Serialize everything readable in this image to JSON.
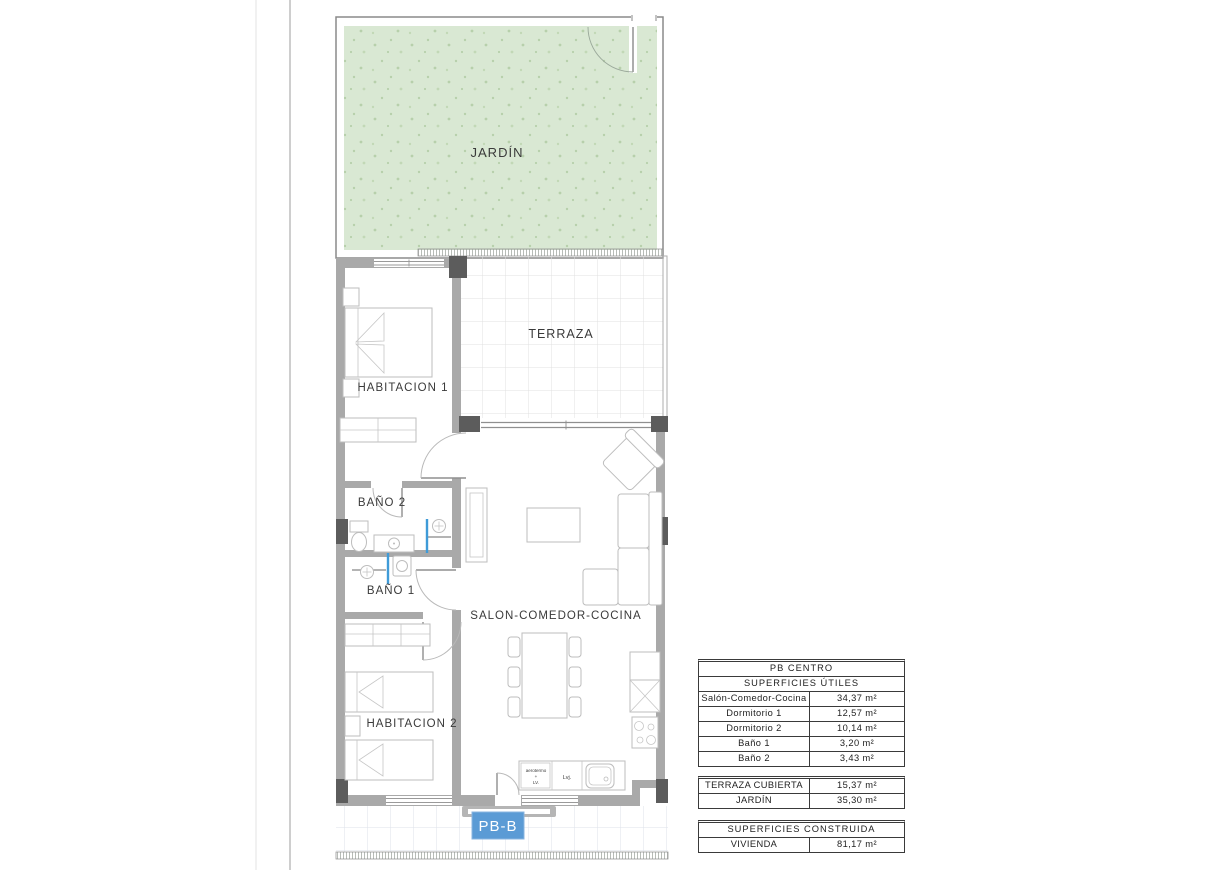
{
  "plan": {
    "unit_badge": "PB-B",
    "labels": {
      "jardin": "JARDÍN",
      "terraza": "TERRAZA",
      "habitacion1": "HABITACION 1",
      "habitacion2": "HABITACION 2",
      "bano1": "BAÑO 1",
      "bano2": "BAÑO 2",
      "salon": "SALON-COMEDOR-COCINA",
      "aerotermo_line1": "aerotermo",
      "aerotermo_line2": "+",
      "aerotermo_line3": "LV.",
      "dishwasher": "Lvj."
    },
    "colors": {
      "garden_fill": "#d9e8d3",
      "garden_speckle": "#b7d0ab",
      "wall_gray": "#a9a9a9",
      "pier_dark": "#5c5c5c",
      "badge_blue": "#5b9bd5",
      "shower_screen_blue": "#3f9bd8"
    }
  },
  "tables": {
    "utiles": {
      "title": "PB CENTRO",
      "subtitle": "SUPERFICIES ÚTILES",
      "rows": [
        {
          "label": "Salón-Comedor-Cocina",
          "value": "34,37 m²"
        },
        {
          "label": "Dormitorio 1",
          "value": "12,57 m²"
        },
        {
          "label": "Dormitorio 2",
          "value": "10,14 m²"
        },
        {
          "label": "Baño 1",
          "value": "3,20 m²"
        },
        {
          "label": "Baño 2",
          "value": "3,43 m²"
        }
      ]
    },
    "exterior": {
      "rows": [
        {
          "label": "TERRAZA CUBIERTA",
          "value": "15,37 m²"
        },
        {
          "label": "JARDÍN",
          "value": "35,30 m²"
        }
      ]
    },
    "construida": {
      "title": "SUPERFICIES CONSTRUIDA",
      "rows": [
        {
          "label": "VIVIENDA",
          "value": "81,17 m²"
        }
      ]
    }
  }
}
